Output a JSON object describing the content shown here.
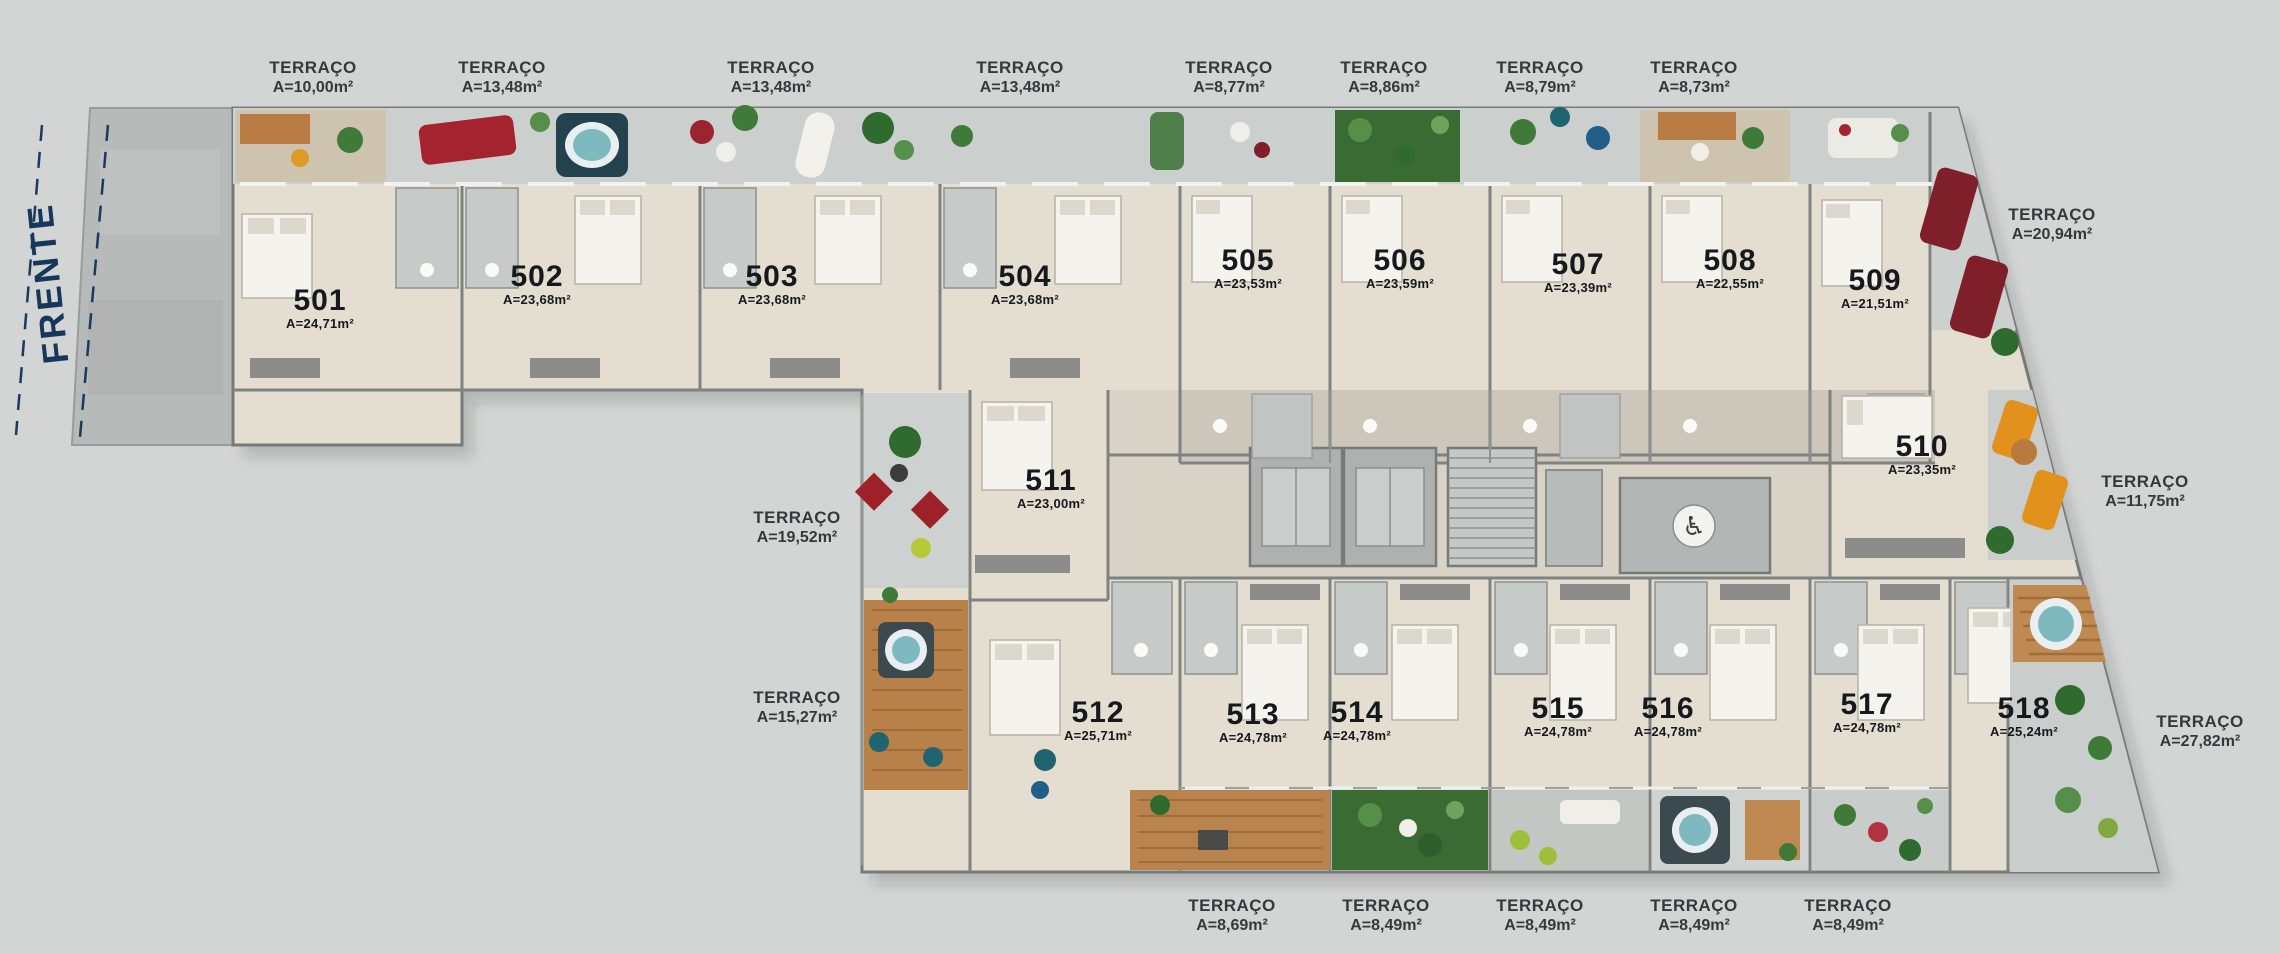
{
  "front_label": "FRENTE",
  "icons": {
    "wheelchair": "♿"
  },
  "colors": {
    "background": "#d3d5d4",
    "building_floor": "#e4ded1",
    "unit_label_text": "#15181c",
    "terrace_label_text": "#313b3a",
    "front_label_navy": "#16365c"
  },
  "units": [
    {
      "number": "501",
      "area": "A=24,71m²"
    },
    {
      "number": "502",
      "area": "A=23,68m²"
    },
    {
      "number": "503",
      "area": "A=23,68m²"
    },
    {
      "number": "504",
      "area": "A=23,68m²"
    },
    {
      "number": "505",
      "area": "A=23,53m²"
    },
    {
      "number": "506",
      "area": "A=23,59m²"
    },
    {
      "number": "507",
      "area": "A=23,39m²"
    },
    {
      "number": "508",
      "area": "A=22,55m²"
    },
    {
      "number": "509",
      "area": "A=21,51m²"
    },
    {
      "number": "510",
      "area": "A=23,35m²"
    },
    {
      "number": "511",
      "area": "A=23,00m²"
    },
    {
      "number": "512",
      "area": "A=25,71m²"
    },
    {
      "number": "513",
      "area": "A=24,78m²"
    },
    {
      "number": "514",
      "area": "A=24,78m²"
    },
    {
      "number": "515",
      "area": "A=24,78m²"
    },
    {
      "number": "516",
      "area": "A=24,78m²"
    },
    {
      "number": "517",
      "area": "A=24,78m²"
    },
    {
      "number": "518",
      "area": "A=25,24m²"
    }
  ],
  "terraces": {
    "top": [
      {
        "label": "TERRAÇO",
        "area": "A=10,00m²"
      },
      {
        "label": "TERRAÇO",
        "area": "A=13,48m²"
      },
      {
        "label": "TERRAÇO",
        "area": "A=13,48m²"
      },
      {
        "label": "TERRAÇO",
        "area": "A=13,48m²"
      },
      {
        "label": "TERRAÇO",
        "area": "A=8,77m²"
      },
      {
        "label": "TERRAÇO",
        "area": "A=8,86m²"
      },
      {
        "label": "TERRAÇO",
        "area": "A=8,79m²"
      },
      {
        "label": "TERRAÇO",
        "area": "A=8,73m²"
      }
    ],
    "right": [
      {
        "label": "TERRAÇO",
        "area": "A=20,94m²"
      },
      {
        "label": "TERRAÇO",
        "area": "A=11,75m²"
      },
      {
        "label": "TERRAÇO",
        "area": "A=27,82m²"
      }
    ],
    "left": [
      {
        "label": "TERRAÇO",
        "area": "A=19,52m²"
      },
      {
        "label": "TERRAÇO",
        "area": "A=15,27m²"
      }
    ],
    "bottom": [
      {
        "label": "TERRAÇO",
        "area": "A=8,69m²"
      },
      {
        "label": "TERRAÇO",
        "area": "A=8,49m²"
      },
      {
        "label": "TERRAÇO",
        "area": "A=8,49m²"
      },
      {
        "label": "TERRAÇO",
        "area": "A=8,49m²"
      },
      {
        "label": "TERRAÇO",
        "area": "A=8,49m²"
      }
    ]
  }
}
